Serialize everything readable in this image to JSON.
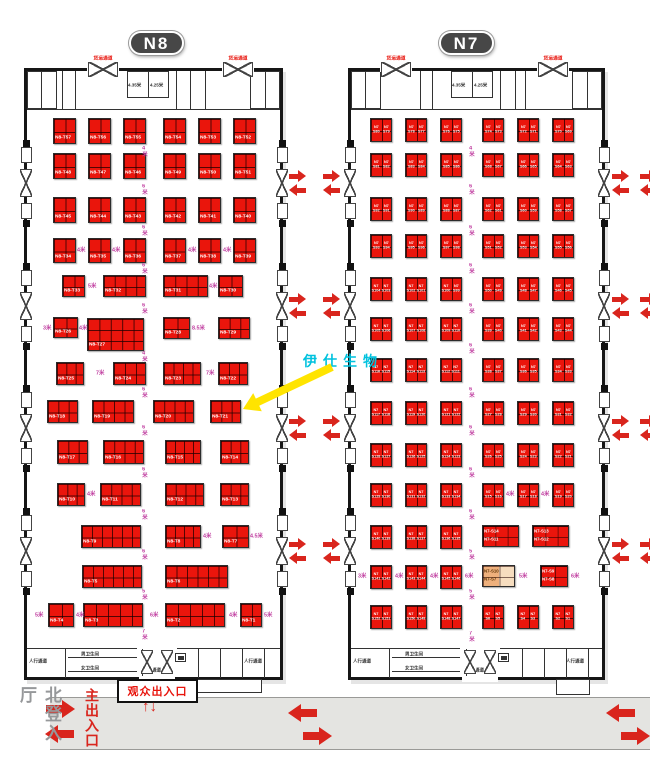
{
  "colors": {
    "booth_red": "#ea150c",
    "arrow_red": "#d9251d",
    "aisle_purple": "#bf3a9e",
    "callout_cyan": "#00c2de",
    "badge_gray": "#474747",
    "band_gray": "#e4e4e1",
    "tan_dark": "#eeb07c",
    "tan_light": "#f6ddbf"
  },
  "badges": [
    {
      "t": "N8",
      "x": 129,
      "y": 31
    },
    {
      "t": "N7",
      "x": 439,
      "y": 31
    }
  ],
  "freight_label": "货运通道",
  "facilities": {
    "ped": "人行通道",
    "wc_m": "男卫生间",
    "wc_f": "女卫生间",
    "dim1": "4.35米",
    "dim2": "4.25米"
  },
  "doors_y": [
    183,
    306,
    428,
    551
  ],
  "arrow_cols": [
    289,
    323,
    612,
    640
  ],
  "halls": [
    {
      "name": "N8",
      "x": 24,
      "y": 68,
      "w": 259,
      "h": 612,
      "cx": 157,
      "tcx": 148,
      "fd": [
        103,
        238
      ],
      "tdiv": [
        62,
        75,
        176,
        190,
        205
      ],
      "bdiv": [
        65,
        142,
        198,
        220,
        242,
        264
      ]
    },
    {
      "name": "N7",
      "x": 348,
      "y": 68,
      "w": 257,
      "h": 612,
      "cx": 480,
      "tcx": 472,
      "fd": [
        396,
        553
      ],
      "tdiv": [
        420,
        432,
        500,
        515,
        525
      ],
      "bdiv": [
        389,
        466,
        522,
        544,
        566,
        588
      ]
    }
  ],
  "booths_n8": [
    [
      "N8-T57",
      53,
      118,
      23,
      26,
      2,
      2
    ],
    [
      "N8-T56",
      88,
      118,
      23,
      26,
      2,
      2
    ],
    [
      "N8-T55",
      123,
      118,
      23,
      26,
      2,
      2
    ],
    [
      "N8-T54",
      163,
      118,
      23,
      26,
      2,
      2
    ],
    [
      "N8-T53",
      198,
      118,
      23,
      26,
      2,
      2
    ],
    [
      "N8-T52",
      233,
      118,
      23,
      26,
      2,
      2
    ],
    [
      "N8-T48",
      53,
      153,
      23,
      26,
      2,
      2
    ],
    [
      "N8-T47",
      88,
      153,
      23,
      26,
      2,
      2
    ],
    [
      "N8-T46",
      123,
      153,
      23,
      26,
      2,
      2
    ],
    [
      "N8-T49",
      163,
      153,
      23,
      26,
      2,
      2
    ],
    [
      "N8-T50",
      198,
      153,
      23,
      26,
      2,
      2
    ],
    [
      "N8-T51",
      233,
      153,
      23,
      26,
      2,
      2
    ],
    [
      "N8-T45",
      53,
      197,
      23,
      26,
      2,
      2
    ],
    [
      "N8-T44",
      88,
      197,
      23,
      26,
      2,
      2
    ],
    [
      "N8-T43",
      123,
      197,
      23,
      26,
      2,
      2
    ],
    [
      "N8-T42",
      163,
      197,
      23,
      26,
      2,
      2
    ],
    [
      "N8-T41",
      198,
      197,
      23,
      26,
      2,
      2
    ],
    [
      "N8-T40",
      233,
      197,
      23,
      26,
      2,
      2
    ],
    [
      "N8-T34",
      53,
      238,
      23,
      25,
      2,
      2
    ],
    [
      "N8-T35",
      88,
      238,
      23,
      25,
      2,
      2
    ],
    [
      "N8-T36",
      123,
      238,
      23,
      25,
      2,
      2
    ],
    [
      "N8-T37",
      163,
      238,
      23,
      25,
      2,
      2
    ],
    [
      "N8-T38",
      198,
      238,
      23,
      25,
      2,
      2
    ],
    [
      "N8-T39",
      233,
      238,
      23,
      25,
      2,
      2
    ],
    [
      "N8-T33",
      62,
      275,
      23,
      22,
      2,
      2
    ],
    [
      "N8-T32",
      103,
      275,
      43,
      22,
      4,
      2
    ],
    [
      "N8-T31",
      163,
      275,
      45,
      22,
      4,
      2
    ],
    [
      "N8-T30",
      218,
      275,
      25,
      22,
      2,
      2
    ],
    [
      "N8-T26",
      53,
      317,
      25,
      21,
      2,
      2
    ],
    [
      "N8-T27",
      87,
      318,
      57,
      33,
      5,
      3
    ],
    [
      "N8-T28",
      163,
      317,
      27,
      22,
      2,
      2
    ],
    [
      "N8-T29",
      218,
      317,
      32,
      22,
      3,
      2
    ],
    [
      "N8-T25",
      56,
      362,
      28,
      23,
      3,
      2
    ],
    [
      "N8-T24",
      113,
      362,
      33,
      23,
      3,
      2
    ],
    [
      "N8-T23",
      163,
      362,
      38,
      23,
      4,
      2
    ],
    [
      "N8-T22",
      218,
      362,
      30,
      23,
      3,
      2
    ],
    [
      "N8-T18",
      47,
      400,
      31,
      23,
      3,
      2
    ],
    [
      "N8-T19",
      92,
      400,
      42,
      23,
      4,
      2
    ],
    [
      "N8-T20",
      153,
      400,
      41,
      23,
      4,
      2
    ],
    [
      "N8-T21",
      210,
      400,
      31,
      23,
      3,
      2
    ],
    [
      "N8-T17",
      57,
      440,
      31,
      24,
      3,
      2
    ],
    [
      "N8-T16",
      103,
      440,
      41,
      24,
      4,
      2
    ],
    [
      "N8-T15",
      165,
      440,
      36,
      24,
      4,
      2
    ],
    [
      "N8-T14",
      220,
      440,
      29,
      24,
      3,
      2
    ],
    [
      "N8-T10",
      57,
      483,
      28,
      23,
      3,
      2
    ],
    [
      "N8-T11",
      100,
      483,
      41,
      23,
      4,
      2
    ],
    [
      "N8-T12",
      165,
      483,
      39,
      23,
      4,
      2
    ],
    [
      "N8-T13",
      220,
      483,
      29,
      23,
      3,
      2
    ],
    [
      "N8-T9",
      81,
      525,
      60,
      23,
      6,
      2
    ],
    [
      "N8-T8",
      165,
      525,
      36,
      23,
      4,
      2
    ],
    [
      "N8-T7",
      222,
      525,
      27,
      23,
      2,
      2
    ],
    [
      "N8-T5",
      82,
      565,
      60,
      23,
      6,
      2
    ],
    [
      "N8-T6",
      165,
      565,
      63,
      23,
      6,
      2
    ],
    [
      "N8-T4",
      48,
      603,
      26,
      24,
      2,
      2
    ],
    [
      "N8-T3",
      83,
      603,
      60,
      24,
      5,
      2
    ],
    [
      "N8-T2",
      165,
      603,
      60,
      24,
      5,
      2
    ],
    [
      "N8-T1",
      240,
      603,
      22,
      24,
      2,
      2
    ]
  ],
  "booths_n7": [
    [
      "S80",
      "S79",
      370,
      118
    ],
    [
      "S78",
      "S77",
      405,
      118
    ],
    [
      "S76",
      "S75",
      440,
      118
    ],
    [
      "S74",
      "S73",
      482,
      118
    ],
    [
      "S72",
      "S71",
      517,
      118
    ],
    [
      "S70",
      "S69",
      552,
      118
    ],
    [
      "S81",
      "S82",
      370,
      153
    ],
    [
      "S83",
      "S84",
      405,
      153
    ],
    [
      "S85",
      "S86",
      440,
      153
    ],
    [
      "S68",
      "S67",
      482,
      153
    ],
    [
      "S66",
      "S65",
      517,
      153
    ],
    [
      "S64",
      "S63",
      552,
      153
    ],
    [
      "S92",
      "S91",
      370,
      197
    ],
    [
      "S90",
      "S89",
      405,
      197
    ],
    [
      "S88",
      "S87",
      440,
      197
    ],
    [
      "S62",
      "S61",
      482,
      197
    ],
    [
      "S60",
      "S59",
      517,
      197
    ],
    [
      "S58",
      "S57",
      552,
      197
    ],
    [
      "S93",
      "S94",
      370,
      234
    ],
    [
      "S95",
      "S96",
      405,
      234
    ],
    [
      "S97",
      "S98",
      440,
      234
    ],
    [
      "S51",
      "S52",
      482,
      234
    ],
    [
      "S53",
      "S54",
      517,
      234
    ],
    [
      "S55",
      "S56",
      552,
      234
    ],
    [
      "S104",
      "S103",
      370,
      277
    ],
    [
      "S102",
      "S101",
      405,
      277
    ],
    [
      "S100",
      "S99",
      440,
      277
    ],
    [
      "S50",
      "S49",
      482,
      277
    ],
    [
      "S48",
      "S47",
      517,
      277
    ],
    [
      "S46",
      "S45",
      552,
      277
    ],
    [
      "S105",
      "S106",
      370,
      317
    ],
    [
      "S107",
      "S108",
      405,
      317
    ],
    [
      "S109",
      "S110",
      440,
      317
    ],
    [
      "S39",
      "S40",
      482,
      317
    ],
    [
      "S41",
      "S42",
      517,
      317
    ],
    [
      "S43",
      "S44",
      552,
      317
    ],
    [
      "S116",
      "S115",
      370,
      358
    ],
    [
      "S114",
      "S113",
      405,
      358
    ],
    [
      "S112",
      "S111",
      440,
      358
    ],
    [
      "S38",
      "S37",
      482,
      358
    ],
    [
      "S36",
      "S35",
      517,
      358
    ],
    [
      "S34",
      "S33",
      552,
      358
    ],
    [
      "S117",
      "S118",
      370,
      401
    ],
    [
      "S119",
      "S120",
      405,
      401
    ],
    [
      "S121",
      "S122",
      440,
      401
    ],
    [
      "S27",
      "S28",
      482,
      401
    ],
    [
      "S29",
      "S30",
      517,
      401
    ],
    [
      "S31",
      "S32",
      552,
      401
    ],
    [
      "S128",
      "S127",
      370,
      443
    ],
    [
      "S126",
      "S125",
      405,
      443
    ],
    [
      "S124",
      "S123",
      440,
      443
    ],
    [
      "S26",
      "S25",
      482,
      443
    ],
    [
      "S24",
      "S23",
      517,
      443
    ],
    [
      "S22",
      "S21",
      552,
      443
    ],
    [
      "S129",
      "S130",
      370,
      483
    ],
    [
      "S131",
      "S132",
      405,
      483
    ],
    [
      "S133",
      "S134",
      440,
      483
    ],
    [
      "S15",
      "S16",
      482,
      483
    ],
    [
      "S17",
      "S18",
      517,
      483
    ],
    [
      "S19",
      "S20",
      552,
      483
    ],
    [
      "S140",
      "S139",
      370,
      525
    ],
    [
      "S138",
      "S137",
      405,
      525
    ],
    [
      "S136",
      "S135",
      440,
      525
    ],
    [
      "S141",
      "S142",
      370,
      565
    ],
    [
      "S143",
      "S144",
      405,
      565
    ],
    [
      "S145",
      "S146",
      440,
      565
    ],
    [
      "S152",
      "S151",
      370,
      605
    ],
    [
      "S150",
      "S149",
      405,
      605
    ],
    [
      "S148",
      "S147",
      440,
      605
    ],
    [
      "S6",
      "S5",
      482,
      605
    ],
    [
      "S4",
      "S3",
      517,
      605
    ],
    [
      "S2",
      "S1",
      552,
      605
    ]
  ],
  "special_n7": [
    {
      "t1": "N7-S14",
      "t2": "N7-S11",
      "x": 482,
      "y": 525,
      "w": 37,
      "h": 22,
      "c": 3,
      "tan": false
    },
    {
      "t1": "N7-S13",
      "t2": "N7-S12",
      "x": 532,
      "y": 525,
      "w": 37,
      "h": 22,
      "c": 3,
      "tan": false
    },
    {
      "t1": "N7-S10",
      "t2": "N7-S7",
      "x": 482,
      "y": 565,
      "w": 33,
      "h": 22,
      "c": 2,
      "tan": true
    },
    {
      "t1": "N7-S9",
      "t2": "N7-S8",
      "x": 540,
      "y": 565,
      "w": 28,
      "h": 22,
      "c": 2,
      "tan": false
    }
  ],
  "aisles_n8": [
    [
      "4米",
      140,
      146,
      1
    ],
    [
      "6米",
      140,
      184,
      1
    ],
    [
      "6米",
      140,
      225,
      1
    ],
    [
      "6米",
      140,
      263,
      1
    ],
    [
      "6米",
      140,
      303,
      1
    ],
    [
      "4米",
      140,
      351,
      1
    ],
    [
      "6米",
      140,
      387,
      1
    ],
    [
      "6米",
      140,
      425,
      1
    ],
    [
      "6米",
      140,
      467,
      1
    ],
    [
      "6米",
      140,
      509,
      1
    ],
    [
      "6米",
      140,
      549,
      1
    ],
    [
      "5米",
      140,
      589,
      1
    ],
    [
      "7米",
      140,
      629,
      1
    ],
    [
      "4米",
      77,
      245,
      0
    ],
    [
      "4米",
      112,
      245,
      0
    ],
    [
      "4米",
      188,
      245,
      0
    ],
    [
      "4米",
      223,
      245,
      0
    ],
    [
      "5米",
      88,
      281,
      0
    ],
    [
      "4米",
      209,
      281,
      0
    ],
    [
      "3米",
      43,
      323,
      0
    ],
    [
      "4米",
      79,
      323,
      0
    ],
    [
      "8.5米",
      192,
      323,
      0
    ],
    [
      "7米",
      96,
      368,
      0
    ],
    [
      "7米",
      206,
      368,
      0
    ],
    [
      "4米",
      87,
      489,
      0
    ],
    [
      "4米",
      203,
      531,
      0
    ],
    [
      "4.5米",
      250,
      531,
      0
    ],
    [
      "5米",
      35,
      610,
      0
    ],
    [
      "4米",
      76,
      610,
      0
    ],
    [
      "6米",
      150,
      610,
      0
    ],
    [
      "4米",
      229,
      610,
      0
    ],
    [
      "5米",
      264,
      610,
      0
    ]
  ],
  "aisles_n7": [
    [
      "4米",
      467,
      146,
      1
    ],
    [
      "6米",
      467,
      184,
      1
    ],
    [
      "6米",
      467,
      225,
      1
    ],
    [
      "6米",
      467,
      263,
      1
    ],
    [
      "6米",
      467,
      303,
      1
    ],
    [
      "6米",
      467,
      343,
      1
    ],
    [
      "6米",
      467,
      387,
      1
    ],
    [
      "6米",
      467,
      425,
      1
    ],
    [
      "6米",
      467,
      467,
      1
    ],
    [
      "6米",
      467,
      509,
      1
    ],
    [
      "5米",
      467,
      549,
      1
    ],
    [
      "5米",
      467,
      589,
      1
    ],
    [
      "7米",
      467,
      631,
      1
    ],
    [
      "4米",
      506,
      489,
      0
    ],
    [
      "4米",
      541,
      489,
      0
    ],
    [
      "3米",
      358,
      571,
      0
    ],
    [
      "4米",
      395,
      571,
      0
    ],
    [
      "4米",
      430,
      571,
      0
    ],
    [
      "6米",
      465,
      571,
      0
    ],
    [
      "5米",
      519,
      571,
      0
    ],
    [
      "6米",
      571,
      571,
      0
    ]
  ],
  "callout": {
    "text": "伊仕生物"
  },
  "bottom": {
    "visitor": "观众出入口",
    "updown": "↑↓",
    "north": "北登入厅",
    "main": "主出入口"
  }
}
